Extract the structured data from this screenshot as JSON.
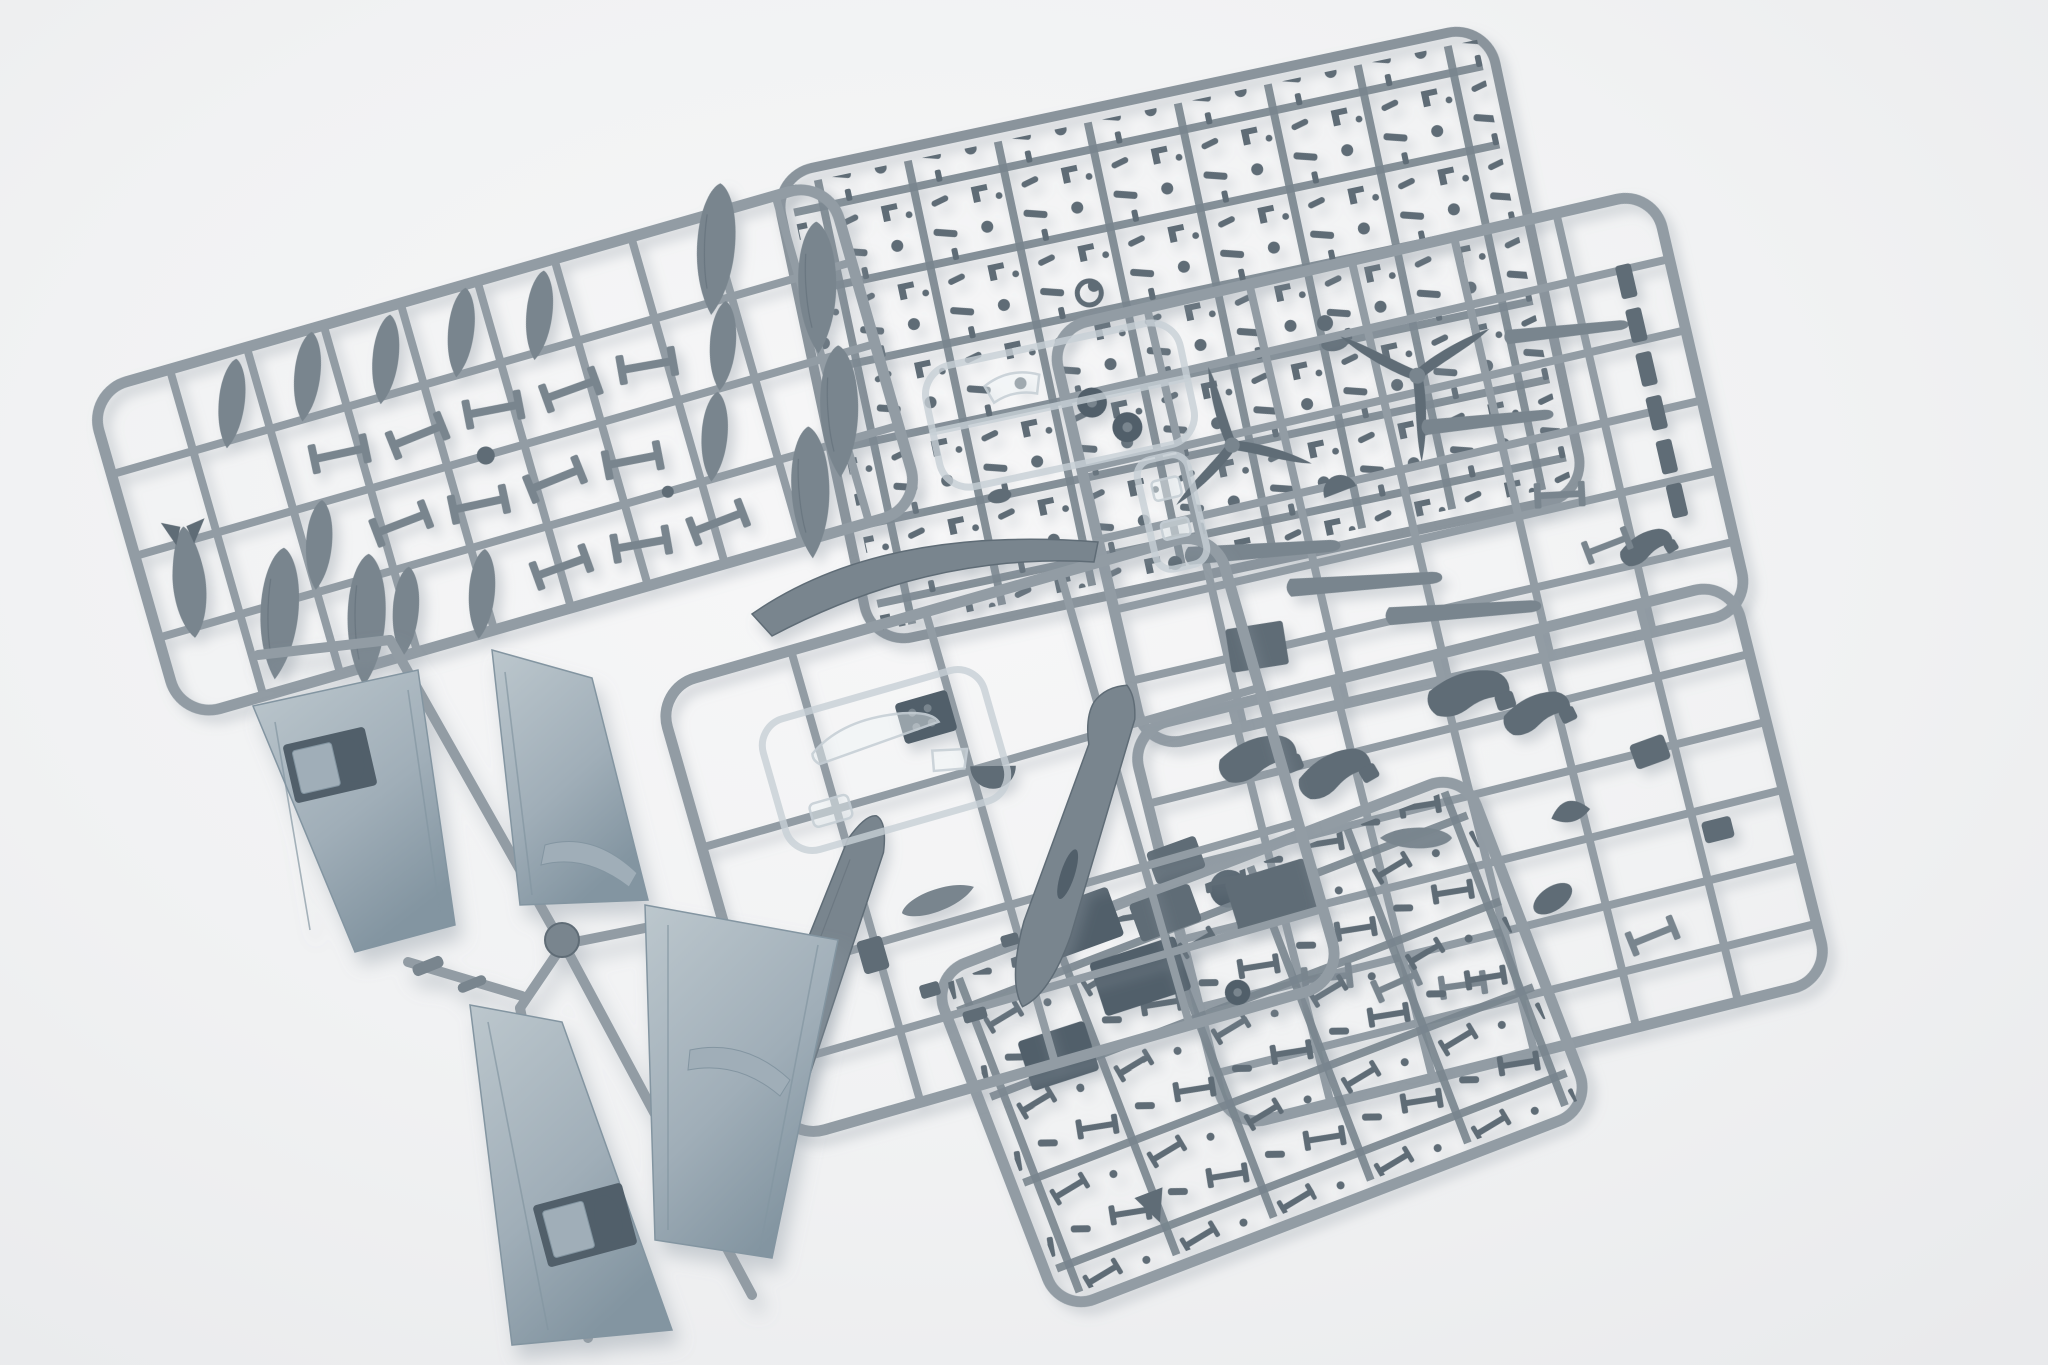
{
  "scene": {
    "subject": "Overhead studio photo of an unbuilt plastic scale-model aircraft kit: seven grey injection-moulded sprues of parts laid on a white background",
    "background_label": "white seamless studio background"
  },
  "palette": {
    "bg-center": "#f7f7f8",
    "bg-mid": "#f1f2f3",
    "bg-edge": "#e9eaec",
    "runner": "#929ca4",
    "runner-dark": "#8a949c",
    "part": "#79858e",
    "part-dark": "#5f6c76",
    "part-deep": "#515f6a",
    "wing": "#a0aeb8",
    "wing-light": "#bcc7cd",
    "wing-dark": "#8395a1",
    "clear-stroke": "#c7d0d6",
    "clear-fill": "#eef3f6",
    "shadow": "#8b96a0"
  },
  "sprues": {
    "tanks": {
      "label": "Sprue A - drop tanks, bomb and small struts"
    },
    "small_parts": {
      "label": "Sprue B - dense grid of tiny detail parts"
    },
    "detail": {
      "label": "Sprue C - propellers, wheels, stabilizers and flaps"
    },
    "fuselage": {
      "label": "Sprue D - fuselage halves, spine, cockpit parts and nose cone"
    },
    "wings": {
      "label": "Sprue E - four large wing panels on cross runner"
    },
    "undercarriage": {
      "label": "Sprue F - undercarriage legs and small airframe parts"
    },
    "cowlings": {
      "label": "Sprue G - engine cowling pieces and fairings"
    },
    "clear": {
      "label": "Clear sprue - canopy, windscreen and transparent parts"
    }
  }
}
